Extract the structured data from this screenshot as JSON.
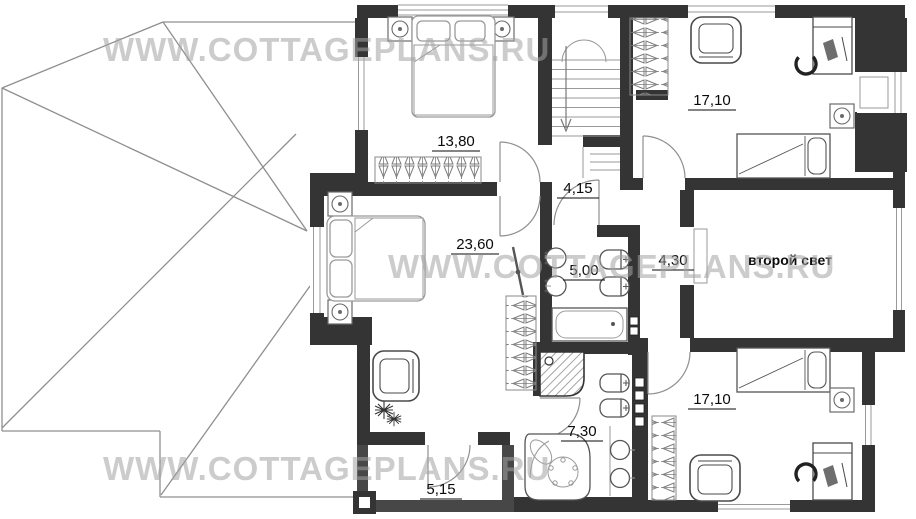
{
  "watermark": {
    "text": "WWW.COTTAGEPLANS.RU"
  },
  "rooms": [
    {
      "name": "bedroom-top-left",
      "area": "13,80"
    },
    {
      "name": "room-top-right",
      "area": "17,10"
    },
    {
      "name": "hall",
      "area": "4,15"
    },
    {
      "name": "master-bedroom",
      "area": "23,60"
    },
    {
      "name": "bathroom",
      "area": "5,00"
    },
    {
      "name": "corridor",
      "area": "4,30"
    },
    {
      "name": "second-light-void",
      "label": "второй свет"
    },
    {
      "name": "room-bottom-right",
      "area": "17,10"
    },
    {
      "name": "master-bathroom",
      "area": "7,30"
    },
    {
      "name": "balcony",
      "area": "5,15"
    }
  ],
  "palette": {
    "wall": "#343434",
    "furniture_light": "#9a9a9a",
    "furniture_dark": "#555555",
    "watermark": "#a3a3a3",
    "label": "#0a0a0a",
    "background": "#ffffff"
  }
}
